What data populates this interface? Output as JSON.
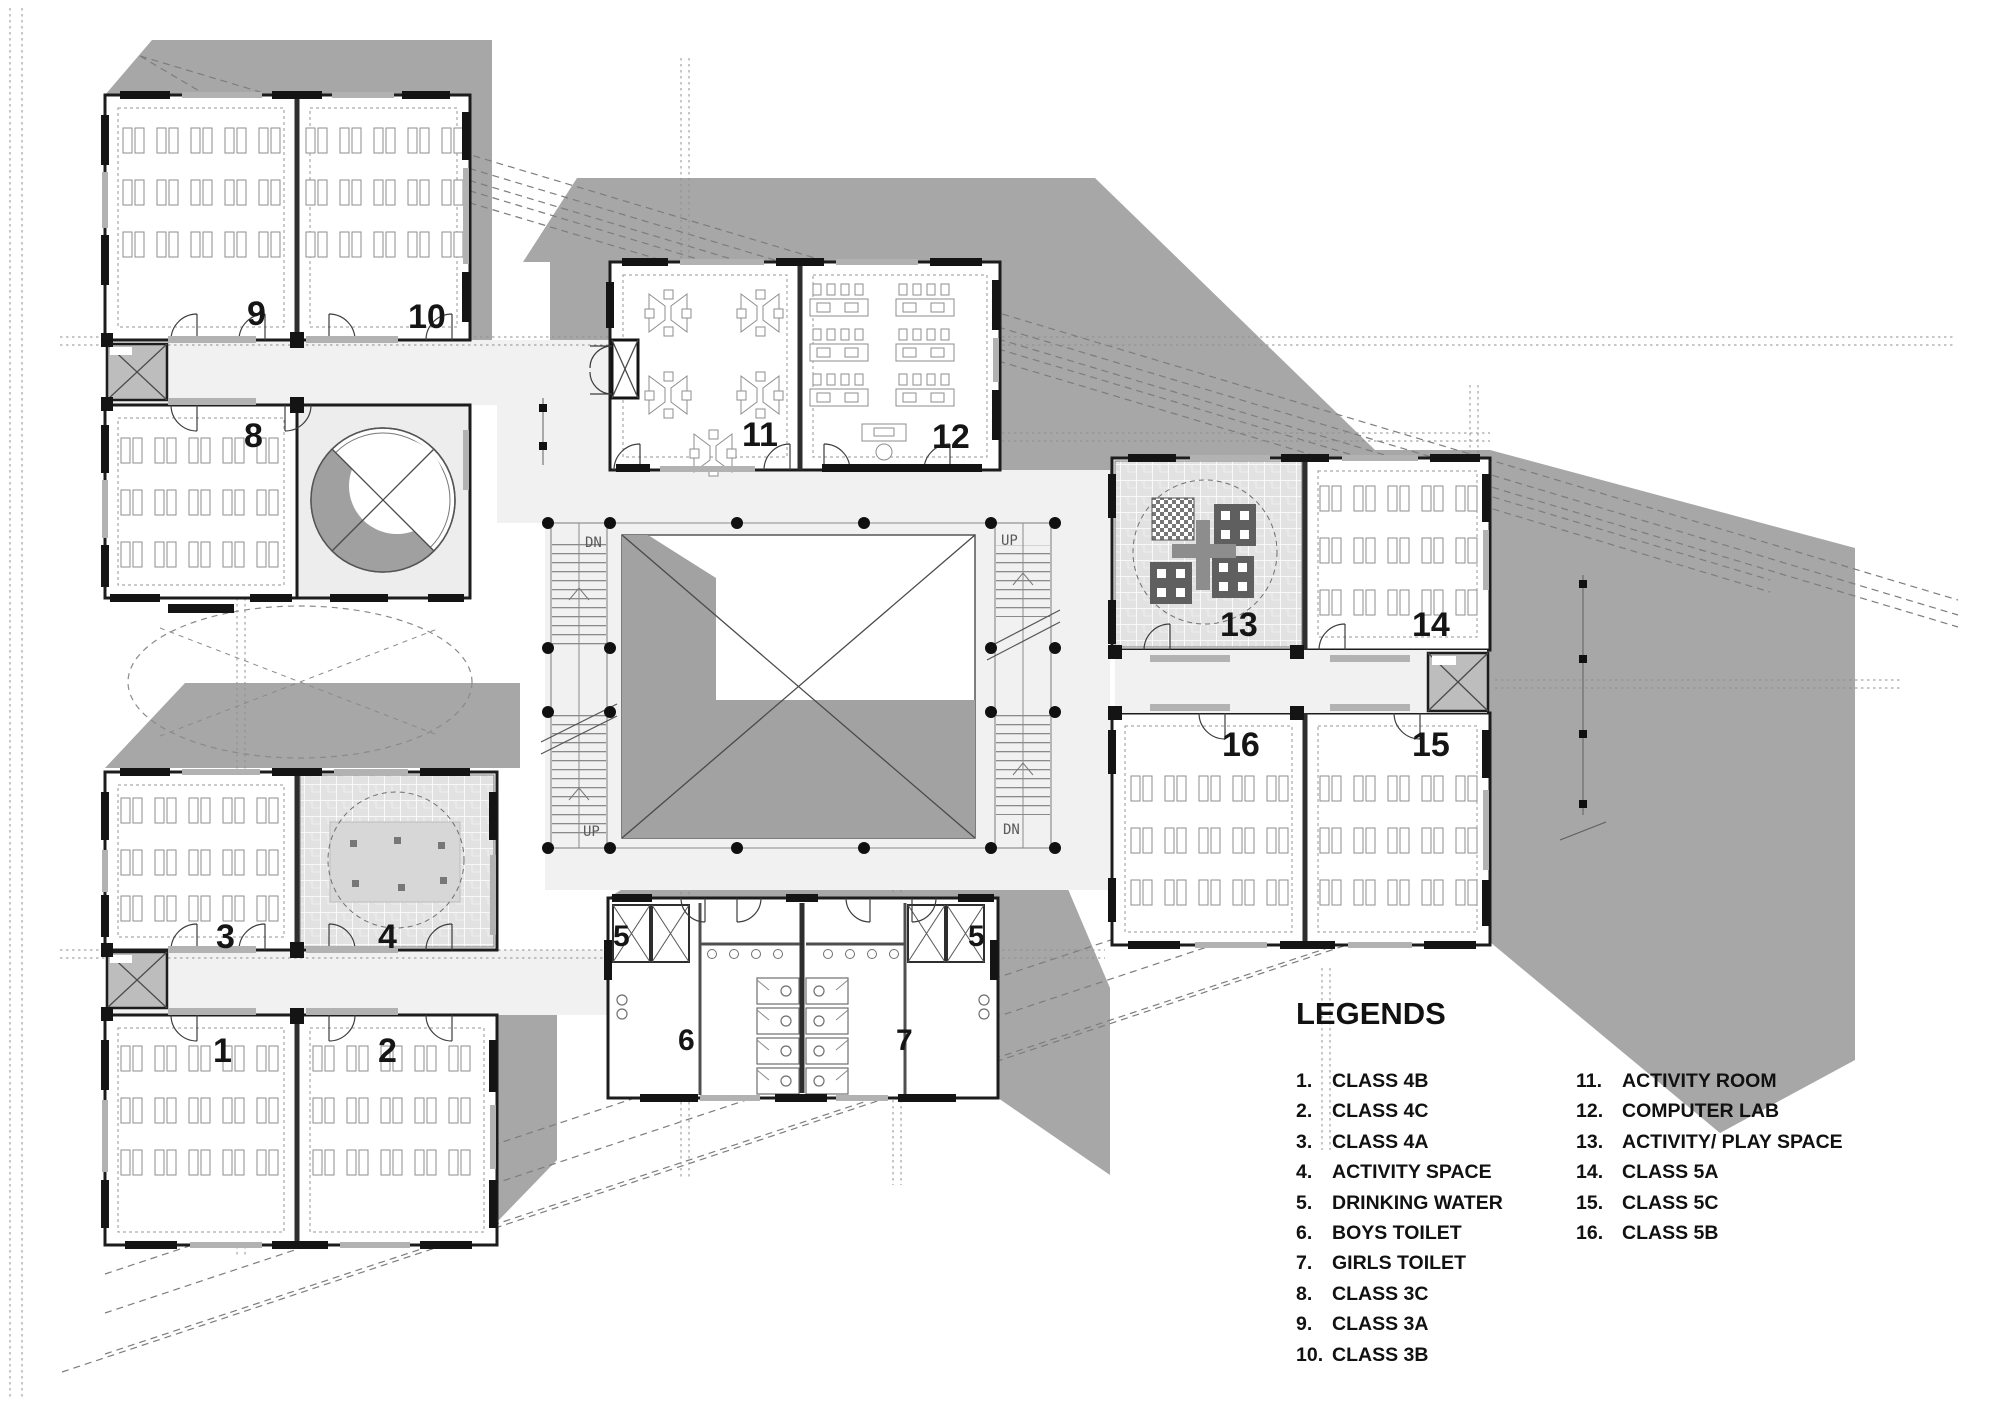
{
  "plan": {
    "room_numbers": [
      "1",
      "2",
      "3",
      "4",
      "5",
      "6",
      "7",
      "8",
      "9",
      "10",
      "11",
      "12",
      "13",
      "14",
      "15",
      "16"
    ],
    "stairs": {
      "left_top": "DN",
      "left_bottom": "UP",
      "right_top": "UP",
      "right_bottom": "DN"
    },
    "colors": {
      "wall": "#1c1c1c",
      "shadow": "#a7a7a7",
      "deck": "#f1f1f1",
      "tile": "#e2e2e2",
      "courtyard_fill": "#a2a2a2"
    }
  },
  "legend": {
    "title": "LEGENDS",
    "col1": [
      {
        "n": "1.",
        "t": "CLASS 4B"
      },
      {
        "n": "2.",
        "t": "CLASS 4C"
      },
      {
        "n": "3.",
        "t": "CLASS 4A"
      },
      {
        "n": "4.",
        "t": "ACTIVITY SPACE"
      },
      {
        "n": "5.",
        "t": "DRINKING WATER"
      },
      {
        "n": "6.",
        "t": "BOYS TOILET"
      },
      {
        "n": "7.",
        "t": "GIRLS TOILET"
      },
      {
        "n": "8.",
        "t": "CLASS 3C"
      },
      {
        "n": "9.",
        "t": "CLASS 3A"
      },
      {
        "n": "10.",
        "t": "CLASS 3B"
      }
    ],
    "col2": [
      {
        "n": "11.",
        "t": "ACTIVITY ROOM"
      },
      {
        "n": "12.",
        "t": "COMPUTER LAB"
      },
      {
        "n": "13.",
        "t": "ACTIVITY/ PLAY SPACE"
      },
      {
        "n": "14.",
        "t": "CLASS 5A"
      },
      {
        "n": "15.",
        "t": "CLASS 5C"
      },
      {
        "n": "16.",
        "t": "CLASS 5B"
      }
    ]
  }
}
